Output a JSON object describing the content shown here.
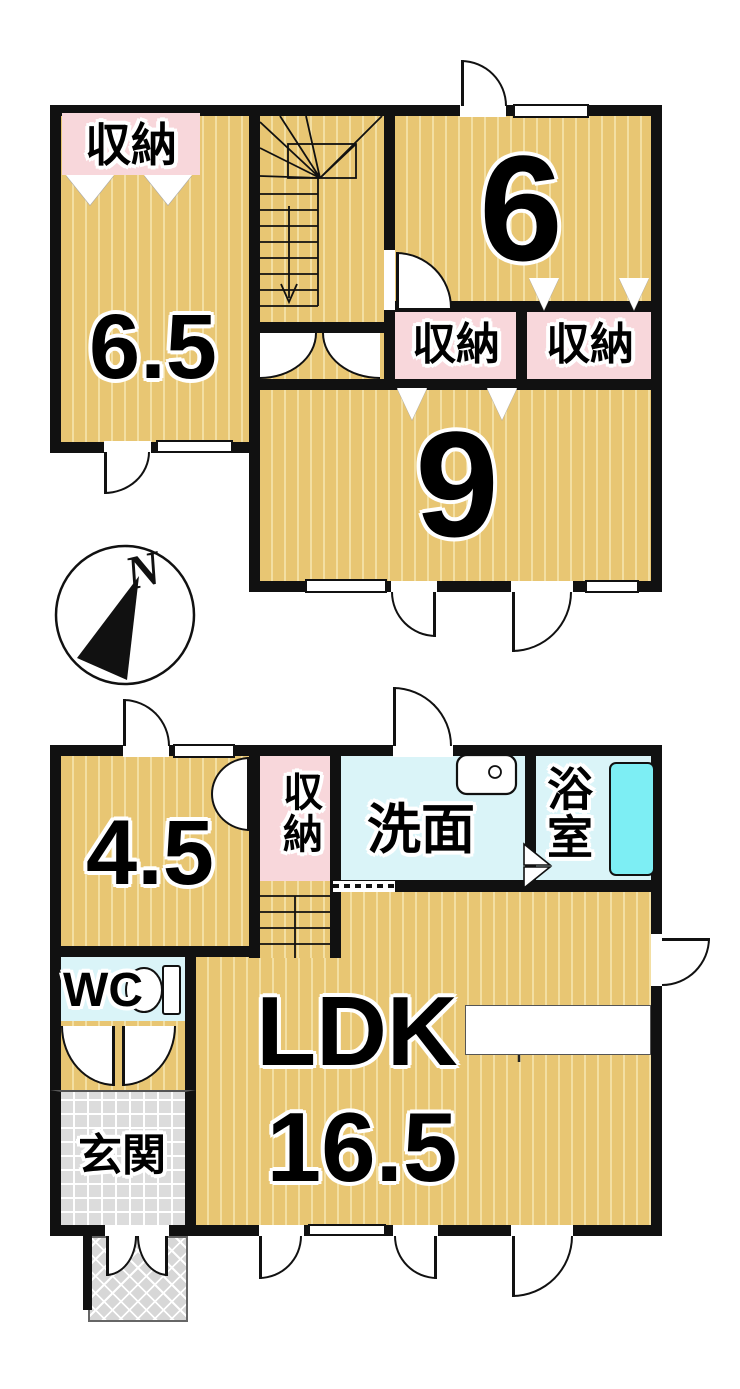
{
  "floor2": {
    "room65_label": "6.5",
    "room65_closet": "収納",
    "room6_label": "6",
    "closet_a": "収納",
    "closet_b": "収納",
    "room9_label": "9"
  },
  "floor1": {
    "room45_label": "4.5",
    "closet": "収納",
    "washroom": "洗面",
    "bathroom": "浴室",
    "wc": "WC",
    "entrance": "玄関",
    "ldk": "LDK",
    "ldk_area": "16.5"
  },
  "compass": {
    "north": "N"
  },
  "colors": {
    "floor": "#e8c673",
    "floor_stripe": "#f3dfa3",
    "closet_pink": "#f8d7db",
    "wet_cyan": "#daf4f8",
    "bathtub": "#7deef4",
    "wall": "#111111",
    "entrance_tile": "#dcdcdc"
  }
}
